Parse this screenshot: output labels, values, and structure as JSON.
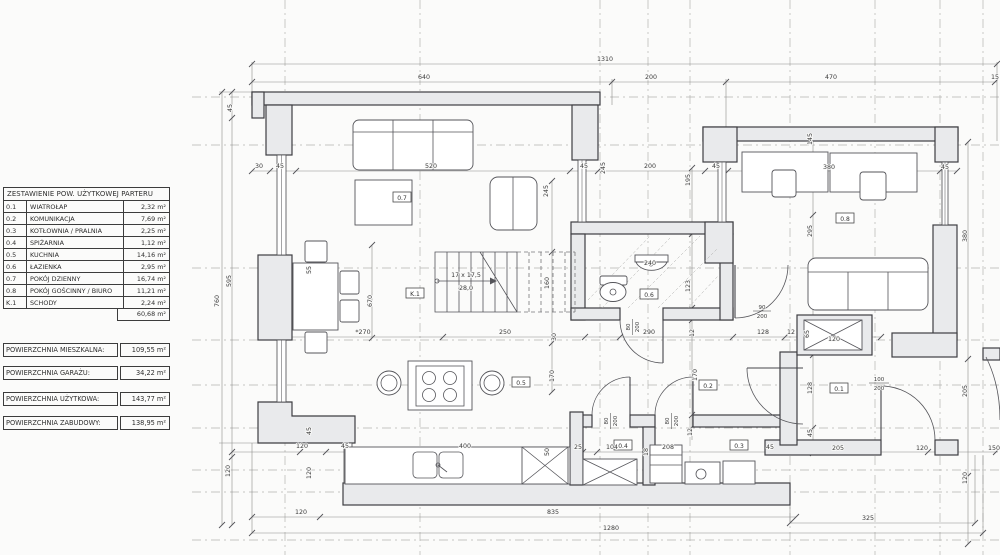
{
  "legend": {
    "title": "ZESTAWIENIE POW. UŻYTKOWEJ PARTERU",
    "rows": [
      {
        "id": "0.1",
        "name": "WIATROŁAP",
        "area": "2,32 m²"
      },
      {
        "id": "0.2",
        "name": "KOMUNIKACJA",
        "area": "7,69 m²"
      },
      {
        "id": "0.3",
        "name": "KOTŁOWNIA / PRALNIA",
        "area": "2,25 m²"
      },
      {
        "id": "0.4",
        "name": "SPIŻARNIA",
        "area": "1,12 m²"
      },
      {
        "id": "0.5",
        "name": "KUCHNIA",
        "area": "14,16 m²"
      },
      {
        "id": "0.6",
        "name": "ŁAZIENKA",
        "area": "2,95 m²"
      },
      {
        "id": "0.7",
        "name": "POKÓJ DZIENNY",
        "area": "16,74 m²"
      },
      {
        "id": "0.8",
        "name": "POKÓJ GOŚCINNY / BIURO",
        "area": "11,21 m²"
      },
      {
        "id": "K.1",
        "name": "SCHODY",
        "area": "2,24 m²"
      }
    ],
    "total_area": "60,68 m²",
    "summary": [
      {
        "label": "POWIERZCHNIA MIESZKALNA:",
        "value": "109,55 m²"
      },
      {
        "label": "POWIERZCHNIA GARAŻU:",
        "value": "34,22 m²"
      },
      {
        "label": "POWIERZCHNIA UŻYTKOWA:",
        "value": "143,77 m²"
      },
      {
        "label": "POWIERZCHNIA ZABUDOWY:",
        "value": "138,95 m²"
      }
    ]
  },
  "plan": {
    "room_labels": [
      "0.7",
      "K.1",
      "0.6",
      "0.5",
      "0.8",
      "0.2",
      "0.4",
      "0.3",
      "0.1"
    ],
    "dims": [
      "1310",
      "640",
      "200",
      "470",
      "15",
      "45",
      "595",
      "760",
      "120",
      "30",
      "45",
      "520",
      "245",
      "45",
      "200",
      "45",
      "195",
      "245",
      "55",
      "670",
      "*270",
      "250",
      "170",
      "160",
      "30",
      "17 x 17,5",
      "28,0",
      "240",
      "123",
      "290",
      "12",
      "128",
      "12",
      "120",
      "65",
      "128",
      "45",
      "295",
      "145",
      "380",
      "45",
      "380",
      "205",
      "120",
      "170",
      "12",
      "25",
      "104",
      "18",
      "208",
      "45",
      "205",
      "120",
      "150",
      "120",
      "45",
      "400",
      "50",
      "120",
      "835",
      "120",
      "325",
      "1280",
      "45"
    ],
    "door_labels": [
      {
        "w": "80",
        "h": "200"
      },
      {
        "w": "80",
        "h": "200"
      },
      {
        "w": "80",
        "h": "200"
      },
      {
        "w": "90",
        "h": "200"
      },
      {
        "w": "100",
        "h": "200"
      }
    ]
  }
}
